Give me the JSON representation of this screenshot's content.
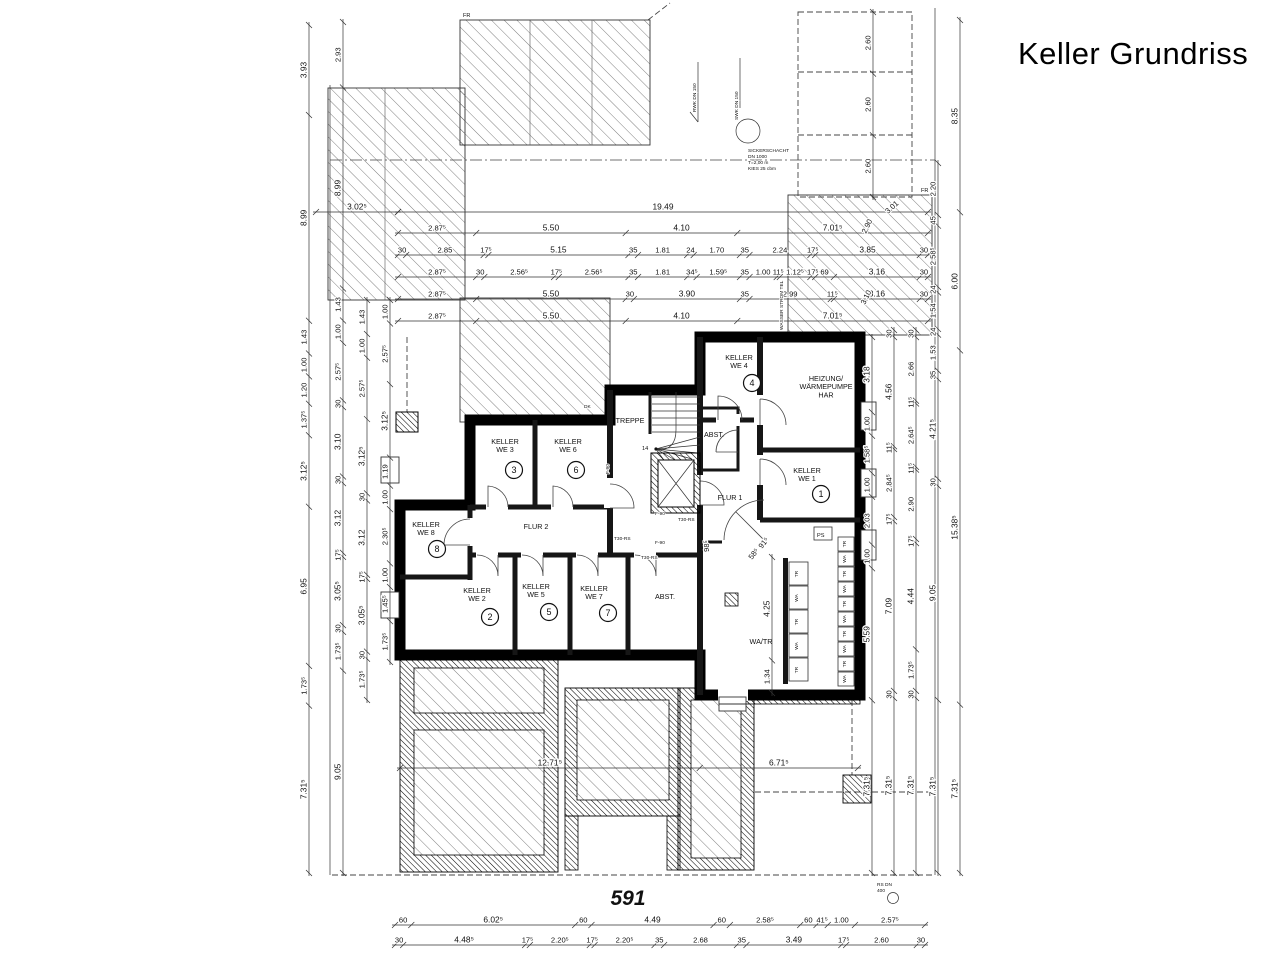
{
  "title": "Keller Grundriss",
  "plot_number": "591",
  "colors": {
    "line": "#1a1a1a",
    "background": "#ffffff"
  },
  "rooms": [
    {
      "id": "we3",
      "name_lines": [
        "KELLER",
        "WE 3"
      ],
      "number": "3"
    },
    {
      "id": "we6",
      "name_lines": [
        "KELLER",
        "WE 6"
      ],
      "number": "6"
    },
    {
      "id": "we8",
      "name_lines": [
        "KELLER",
        "WE 8"
      ],
      "number": "8"
    },
    {
      "id": "we2",
      "name_lines": [
        "KELLER",
        "WE 2"
      ],
      "number": "2"
    },
    {
      "id": "we5",
      "name_lines": [
        "KELLER",
        "WE 5"
      ],
      "number": "5"
    },
    {
      "id": "we7",
      "name_lines": [
        "KELLER",
        "WE 7"
      ],
      "number": "7"
    },
    {
      "id": "we4",
      "name_lines": [
        "KELLER",
        "WE 4"
      ],
      "number": "4"
    },
    {
      "id": "we1",
      "name_lines": [
        "KELLER",
        "WE 1"
      ],
      "number": "1"
    },
    {
      "id": "heizung",
      "name_lines": [
        "HEIZUNG/",
        "WÄRMEPUMPE",
        "HAR"
      ],
      "number": null
    },
    {
      "id": "treppe",
      "name_lines": [
        "TREPPE"
      ],
      "number": null
    },
    {
      "id": "flur1",
      "name_lines": [
        "FLUR 1"
      ],
      "number": null
    },
    {
      "id": "flur2",
      "name_lines": [
        "FLUR 2"
      ],
      "number": null
    },
    {
      "id": "abst1",
      "name_lines": [
        "ABST."
      ],
      "number": null
    },
    {
      "id": "abst2",
      "name_lines": [
        "ABST."
      ],
      "number": null
    },
    {
      "id": "watr",
      "name_lines": [
        "WA/TR"
      ],
      "number": null
    }
  ],
  "dims": {
    "t0": [
      "3.02⁵"
    ],
    "t1": [
      "19.49"
    ],
    "t2": [
      "2.87⁵",
      "5.50",
      "4.10",
      "7.01⁵"
    ],
    "t3": [
      "30",
      "2.85",
      "17⁵",
      "5.15",
      "35",
      "1.81",
      "24",
      "1.70",
      "35",
      "2.24",
      "17⁵",
      "3.85",
      "30"
    ],
    "t4": [
      "2.87⁵",
      "30",
      "2.56⁵",
      "17⁵",
      "2.56⁵",
      "35",
      "1.81",
      "34⁵",
      "1.59⁵",
      "35",
      "1.00",
      "11⁵",
      "1.12⁵",
      "17⁵",
      "69",
      "3.16",
      "30"
    ],
    "t5": [
      "2.87⁵",
      "5.50",
      "30",
      "3.90",
      "35",
      "2.99",
      "11⁵",
      "3.16",
      "30"
    ],
    "t6": [
      "2.87⁵",
      "5.50",
      "4.10",
      "7.01⁵"
    ],
    "b1": [
      "60",
      "6.02⁵",
      "60",
      "4.49",
      "60",
      "2.58⁵",
      "60",
      "41⁵",
      "1.00",
      "2.57⁵"
    ],
    "b2": [
      "30",
      "4.48⁵",
      "17⁵",
      "2.20⁵",
      "17⁵",
      "2.20⁵",
      "35",
      "2.68",
      "35",
      "3.49",
      "17⁵",
      "2.60",
      "30"
    ],
    "bl": [
      "12.71⁵",
      "6.71⁵"
    ],
    "la": [
      "3.93",
      "8.99",
      "1.43",
      "1.00",
      "1.20",
      "1.37⁵",
      "3.12⁵",
      "6.95",
      "1.73⁵",
      "7.31⁵"
    ],
    "lb": [
      "2.93",
      "8.99",
      "1.43",
      "1.00",
      "2.57⁵",
      "30",
      "3.10",
      "30",
      "3.12",
      "17⁵",
      "3.05⁵",
      "30",
      "1.73⁵",
      "9.05"
    ],
    "lc": [
      "1.43",
      "1.00",
      "2.57⁵",
      "3.12⁵",
      "30",
      "3.12",
      "17⁵",
      "3.05⁵",
      "30",
      "1.73⁵"
    ],
    "ld": [
      "1.00",
      "2.57⁵",
      "3.12⁵",
      "1.19",
      "1.00",
      "2.30⁵",
      "1.00",
      "1.45⁵",
      "1.73⁵"
    ],
    "r1": [
      "3.18",
      "1.00",
      "1.58⁵",
      "1.00",
      "2.03",
      "1.00",
      "5.59",
      "7.31⁵"
    ],
    "r2": [
      "30",
      "4.56",
      "11⁵",
      "2.84⁵",
      "17⁵",
      "7.09",
      "30",
      "7.31⁵"
    ],
    "r3": [
      "30",
      "2.66",
      "11⁵",
      "2.64⁵",
      "11⁵",
      "2.90",
      "17⁵",
      "4.44",
      "1.73⁵",
      "30",
      "7.31⁵"
    ],
    "r4": [
      "2.20",
      "45",
      "2.58⁵",
      "24",
      "1.54",
      "24",
      "1.53",
      "35",
      "4.21⁵",
      "30",
      "9.05",
      "7.31⁵"
    ],
    "r5": [
      "8.35",
      "6.00",
      "15.38⁵",
      "7.31⁵"
    ],
    "g1": [
      "2.60",
      "2.60",
      "2.60"
    ],
    "w1": [
      "4.25",
      "1.34"
    ],
    "diag": [
      "3.01",
      "2.90",
      "3.10"
    ],
    "door_dims": [
      "98⁵",
      "58⁵",
      "91⁵"
    ]
  },
  "annotations": {
    "fr": "FR",
    "dk": "DK",
    "f90": "F-90",
    "t30rs": "T30-RS",
    "stair_count": "14",
    "ps": "PS",
    "wasser": "WASSER STROM TEL",
    "rwk": "RWK DN 150",
    "swk": "SWK DN 150",
    "sicker_lines": [
      "SICKERSCHACHT",
      "DN 1000",
      "T=2,00 m",
      "KIES 25 cbm"
    ],
    "rs_dn_lines": [
      "RS DN",
      "400"
    ]
  },
  "equipment": {
    "washer_wall_row": [
      "TR",
      "WA",
      "TR",
      "WA",
      "TR",
      "WA",
      "TR",
      "WA",
      "TR",
      "WA"
    ],
    "washer_island": [
      "TR",
      "WA",
      "TR",
      "WA",
      "TR"
    ]
  }
}
